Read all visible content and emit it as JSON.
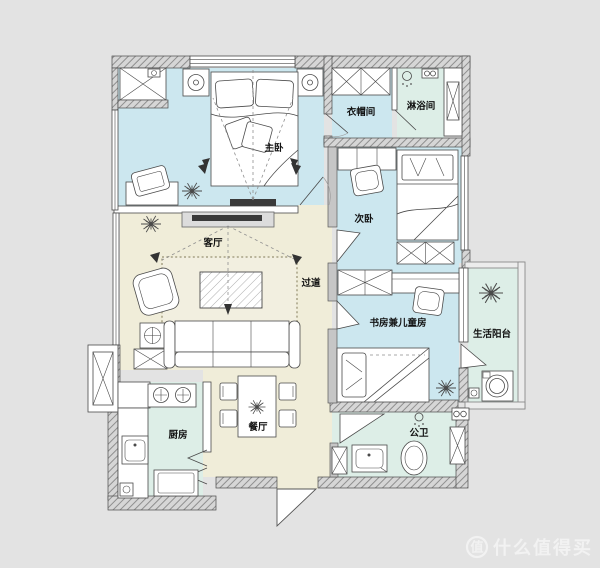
{
  "plan": {
    "rooms": {
      "master_bedroom": "主卧",
      "cloakroom": "衣帽间",
      "shower_room": "淋浴间",
      "second_bedroom": "次卧",
      "living_room": "客厅",
      "hallway": "过道",
      "study_kids_room": "书房兼儿童房",
      "utility_balcony": "生活阳台",
      "kitchen": "厨房",
      "dining_room": "餐厅",
      "guest_bathroom": "公卫"
    },
    "colors": {
      "background": "#e3e3e3",
      "bedroom_floor": "#cce7ef",
      "wet_area_floor": "#ddeee7",
      "living_floor": "#f0edd9",
      "rug_fill": "#f2efe0",
      "wall_fill": "#d6d6d6",
      "wall_hatch": "#8f8f8f",
      "watermark": "#f2f2f2"
    }
  },
  "watermark": {
    "badge": "值",
    "text": "什么值得买"
  }
}
